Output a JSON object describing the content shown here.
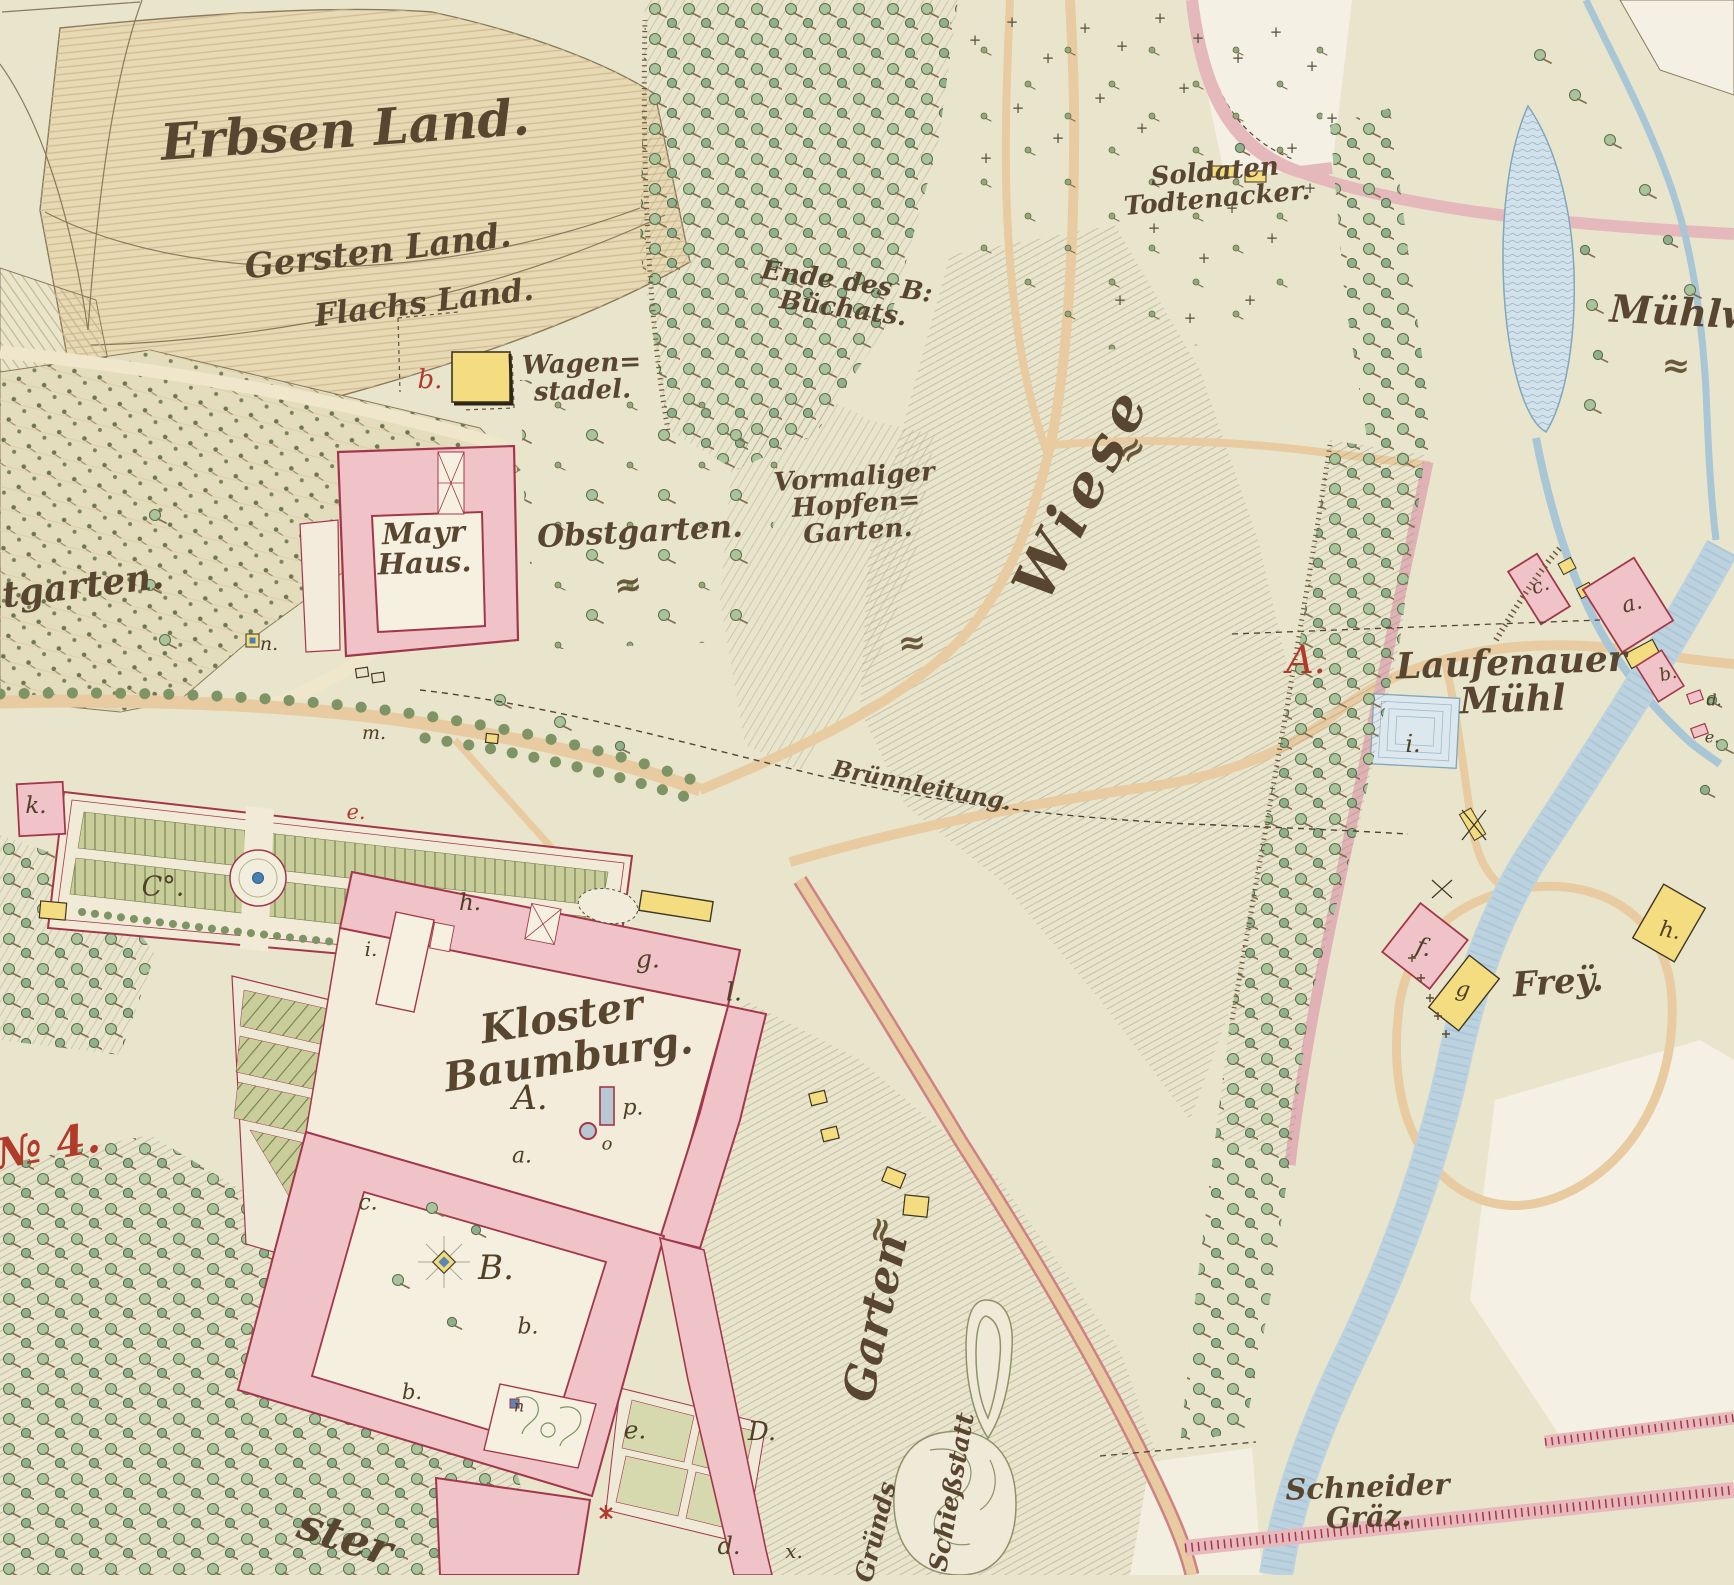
{
  "palette": {
    "parchment": "#e9e5cc",
    "building_pink": "#f0c3c8",
    "building_outline": "#a2374b",
    "building_yellow": "#f3dd80",
    "water_fill": "#d3e2ea",
    "water_line": "#7fa6bb",
    "road_tan": "#e8cba0",
    "road_pink": "#e5b8bc",
    "tree_green": "#a9c49b",
    "hatch_gray": "#97937f",
    "ink_brown": "#594630",
    "ink_red": "#b23a2b"
  },
  "labels": {
    "erbsen": "Erbsen Land.",
    "gersten": "Gersten Land.",
    "flachs": "Flachs Land.",
    "wagenstadel": "Wagen=\nstadel.",
    "mayrhaus": "Mayr\nHaus.",
    "obstgarten": "Obstgarten.",
    "hopfengarten": "Vormaliger\nHopfen=\nGarten.",
    "wiese": "Wiese",
    "buchats": "Ende des B:\nBüchats.",
    "soldaten": "Soldaten\nTodtenacker.",
    "muehlw": "Mühlw",
    "laufenauer": "Laufenauer\nMühl",
    "bruennleitung": "Brünnleitung.",
    "kloster": "Kloster\nBaumburg.",
    "frey": "Freÿ.",
    "schneider": "Schneider\nGräz.",
    "krautgarten": "utgarten.",
    "no4": "№ 4.",
    "garten_slope": "Garten",
    "schiessstatt": "Schießstatt",
    "gruends": "Gründs",
    "kloster_fragment": "ster"
  },
  "letters": {
    "wagen_b": "b.",
    "laufen_A": "A.",
    "garden_k": "k.",
    "garden_C": "C°.",
    "road_e": "e.",
    "road_m": "m.",
    "conduit_n": "n.",
    "kl_i": "i.",
    "kl_h": "h.",
    "kl_g": "g.",
    "kl_l": "l.",
    "kl_A": "A.",
    "kl_p": "p.",
    "kl_o": "o",
    "kl_a": "a.",
    "kl_c": "c.",
    "kl_B": "B.",
    "kl_b": "b.",
    "kl_b2": "b.",
    "kl_n": "n",
    "kl_e": "e.",
    "kl_d": "d.",
    "kl_D": "D.",
    "kl_x": "x.",
    "pond_i": "i.",
    "lf_c": "c.",
    "lf_a": "a.",
    "lf_b": "b.",
    "lf_d": "d.",
    "lf_e": "e.",
    "fr_f": "f.",
    "fr_g": "g",
    "fr_h": "h."
  },
  "symbols": {
    "flourish": "≈",
    "cross": "+"
  },
  "cemetery_crosses": [
    [
      975,
      40
    ],
    [
      1012,
      22
    ],
    [
      1048,
      58
    ],
    [
      1085,
      28
    ],
    [
      1122,
      46
    ],
    [
      1160,
      18
    ],
    [
      1198,
      38
    ],
    [
      1238,
      58
    ],
    [
      1276,
      32
    ],
    [
      1312,
      66
    ],
    [
      1332,
      118
    ],
    [
      1292,
      148
    ],
    [
      1184,
      88
    ],
    [
      1142,
      128
    ],
    [
      1100,
      98
    ],
    [
      1058,
      138
    ],
    [
      1018,
      108
    ],
    [
      986,
      158
    ],
    [
      1232,
      208
    ],
    [
      1272,
      238
    ],
    [
      1204,
      258
    ],
    [
      1154,
      228
    ],
    [
      1310,
      188
    ],
    [
      1250,
      300
    ],
    [
      1190,
      318
    ],
    [
      1120,
      300
    ]
  ],
  "flourishes": [
    [
      628,
      585,
      -8
    ],
    [
      912,
      643,
      -6
    ],
    [
      1132,
      450,
      -42
    ],
    [
      1676,
      366,
      2
    ],
    [
      880,
      1230,
      -78
    ]
  ]
}
